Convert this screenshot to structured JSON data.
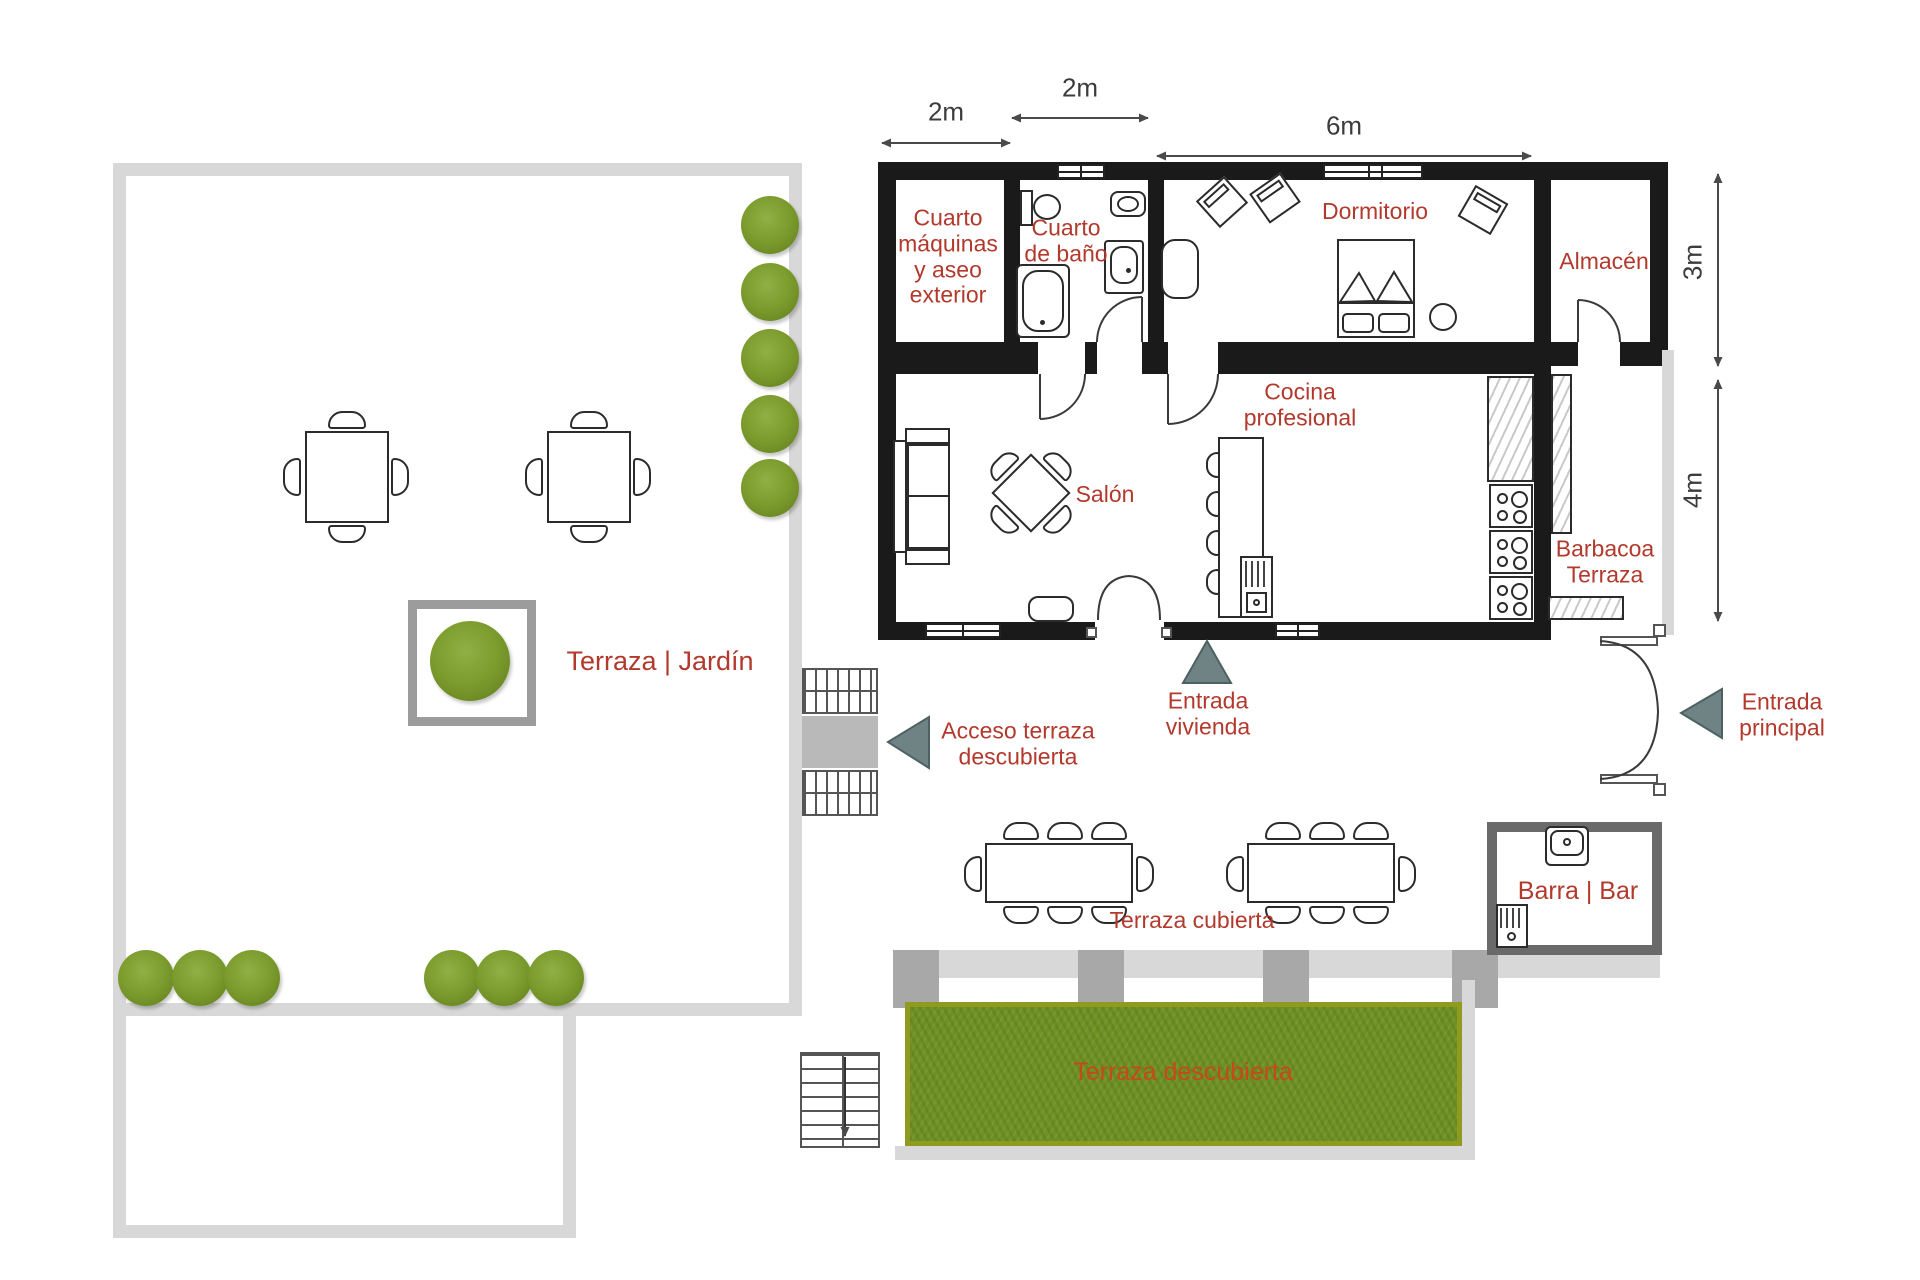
{
  "colors": {
    "label_red": "#b2392c",
    "terrace_label_orange": "#c7481b",
    "wall_black": "#1a1a1a",
    "frame_gray": "#d8d8d8",
    "pillar_gray": "#a8a8a8",
    "bar_wall_gray": "#6a6a6a",
    "bush_green": "#7d9c2e",
    "grass_green": "#6f9123",
    "grass_border": "#8e9b1f",
    "arrow_gray": "#6f8384",
    "dim_color": "#4a4a4a"
  },
  "labels": {
    "machine_room": "Cuarto\nmáquinas\ny aseo\nexterior",
    "bathroom": "Cuarto\nde baño",
    "bedroom": "Dormitorio",
    "storage": "Almacén",
    "kitchen": "Cocina\nprofesional",
    "living_room": "Salón",
    "bbq": "Barbacoa\nTerraza",
    "garden": "Terraza | Jardín",
    "terrace_access": "Acceso terraza\ndescubierta",
    "home_entrance": "Entrada\nvivienda",
    "main_entrance": "Entrada\nprincipal",
    "covered_terrace": "Terraza cubierta",
    "bar": "Barra | Bar",
    "open_terrace": "Terraza descubierta"
  },
  "dimensions": {
    "machine_room_width": "2m",
    "bathroom_width": "2m",
    "bedroom_width": "6m",
    "storage_height": "3m",
    "living_height": "4m"
  }
}
